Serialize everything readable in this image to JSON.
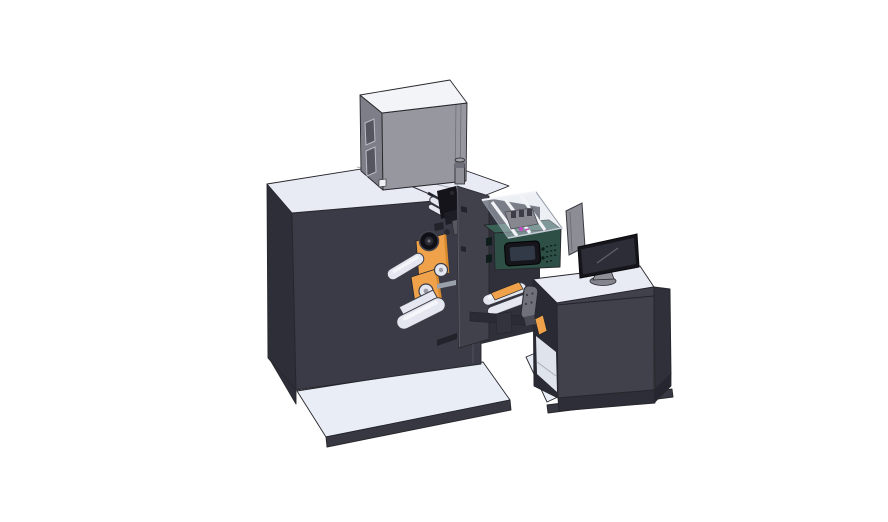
{
  "figure": {
    "description": "Isometric 3D CAD rendering of an industrial label printing and rewinding machine: large dark cabinet with gray control box on top, white guide rollers with orange material rolls, a dark-green electronics module with small display under a transparent cover, and an operator desk with a monitor, all standing on light base plates against a white background",
    "objects": [
      {
        "id": "base-plate-left",
        "label": "machine base plate"
      },
      {
        "id": "main-cabinet",
        "label": "main machine cabinet"
      },
      {
        "id": "top-control-box",
        "label": "gray control box on cabinet top"
      },
      {
        "id": "exhaust-cylinder",
        "label": "small cylinder on cabinet top"
      },
      {
        "id": "material-rolls",
        "label": "orange material rolls"
      },
      {
        "id": "roller-assembly-left",
        "label": "white guide rollers"
      },
      {
        "id": "print-head",
        "label": "black print head mechanism"
      },
      {
        "id": "mounting-plate",
        "label": "vertical mounting plate"
      },
      {
        "id": "web-path-right",
        "label": "web path rollers and beam"
      },
      {
        "id": "operator-desk",
        "label": "operator desk with base plate"
      },
      {
        "id": "electronics-module",
        "label": "dark green electronics module with display"
      },
      {
        "id": "clear-cover",
        "label": "transparent cover with struts"
      },
      {
        "id": "side-panel",
        "label": "gray divider panel"
      },
      {
        "id": "monitor",
        "label": "desktop monitor on round stand"
      },
      {
        "id": "control-handle",
        "label": "gray control handle"
      }
    ]
  },
  "colors": {
    "bg": "#ffffff",
    "edge": "#26262c",
    "cabFront": "#3b3b47",
    "cabSide": "#2e2e38",
    "cabTop": "#e8ebf4",
    "recess": "#30303b",
    "boxTop": "#f3f4f8",
    "boxFront": "#97979f",
    "boxSide": "#7e7e88",
    "boxWin": "#565660",
    "plate": "#41414c",
    "mechDark": "#14141a",
    "mechMid": "#2a2a33",
    "mechGray": "#575760",
    "roller": "#e4e7ef",
    "rollerEdge": "#3e3e48",
    "rollerHi": "#f7f8fb",
    "orange": "#efa24a",
    "orangeDeep": "#d88a2e",
    "teal": "#2d4f46",
    "tealTop": "#3a6156",
    "tealDark": "#0e1d19",
    "coverEdge": "#8f96a3",
    "strut": "#f1f3f7",
    "deskFront": "#41414c",
    "deskSide": "#2a2a34",
    "deskRight": "#30303a",
    "deskTop": "#e8ebf4",
    "plinth": "#2e2e38",
    "shelfLight": "#dfe3ec",
    "baseTop": "#e9edf6",
    "baseEdge": "#383842",
    "panelGray": "#8d8d95",
    "handle": "#70707a",
    "monBezel": "#15151b",
    "monScreen": "#2d2d37",
    "monStand": "#8f8f98",
    "magenta": "#c24ec2"
  }
}
